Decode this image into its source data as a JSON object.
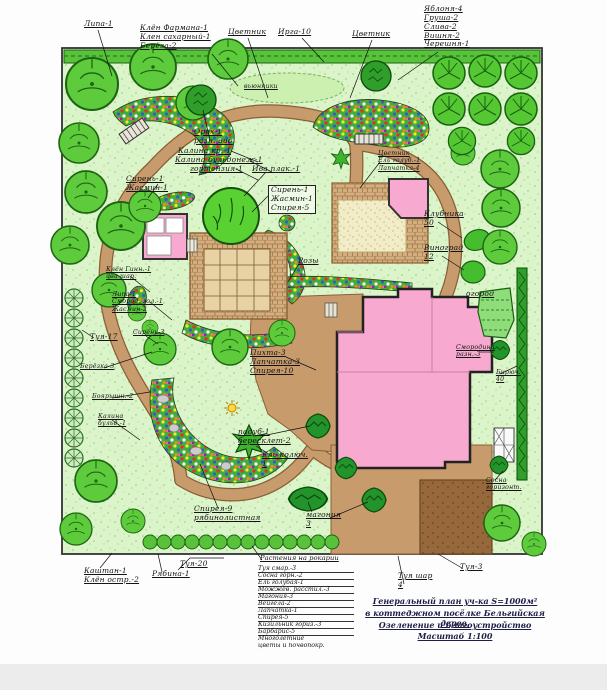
{
  "plan": {
    "callouts": {
      "lipa": "Липа-1",
      "maple_stack": "Клён Фармана-1\nКлен сахарный-1\nБерёза-2",
      "flowerbed_left": "Цветник",
      "irga": "Ирга-10",
      "flowerbed_right": "Цветник",
      "fruit_stack": "Яблоня-4\nГруша-2\nСлива-2\nВишня-2\nЧерешня-1",
      "lawn_oval": "вьюнники",
      "walnut": "Орех-1\nразн. вид",
      "kalina_kr": "Калина кр.-1",
      "kalina_buldonezh": "Калина бульдонеж-1",
      "gortenziya": "гортензия-1",
      "siren_zhasmin": "Сирень-1\nЖасмин-1",
      "iva_plak": "Ива плак.-1",
      "shrub_box": "Сирень-1\nЖасмин-1\nСпирея-5",
      "gazebo_stack": "Цветник\nЕль голуб.-1\nЛапчатка-4",
      "klubnika": "Клубника\n50",
      "vinograd": "Виноград\n12",
      "ogorod": "огород",
      "smorodina": "Смородина\nразн.-3",
      "biryuchina": "Бирюч.\n40",
      "rozy": "Розы",
      "pihta_box": "Пихта-3\nЛапчатка-3\nСпирея-10",
      "padub": "падуб-1\nбересклет-2",
      "el_kolyuchaya": "Ель колюч.\n1",
      "spireya_ryab": "Спирея-9\nрябинолистная",
      "magoniya": "магония\n3",
      "sosna_goriz": "Сосна\nгоризонт.",
      "tuya_17": "Туя-17",
      "beryozka": "Берёзка-3",
      "boyaryshnik": "Боярышн.-2",
      "kalina_buld_left": "Калина\nбульд.-1",
      "lipa_stack_left": "Липа-1\nСмород. зол.-1\nЖасмин-2",
      "siren_3": "Сирень-3",
      "klen_ginn": "Клён Гинн.-1\nива шар.",
      "kashtan": "Каштан-1\nКлён остр.-2",
      "ryabina": "Рябина-1",
      "tuya_20": "Туя-20",
      "tuya_shar": "Туя шар\n4",
      "tuya_3": "Туя-3"
    }
  },
  "legend": {
    "header": "Растения на рокарии",
    "items": [
      "Туя смар.-3",
      "Сосна горн.-2",
      "Ель голубая-1",
      "Можжев. расстил.-3",
      "Магония-3",
      "Вейгела-2",
      "Лапчатка-1",
      "Спирея-5",
      "Кизильник гориз.-3",
      "Барбарис-5",
      "Многолетние\nцветы и почвопокр."
    ]
  },
  "title_block": {
    "lines": [
      "Генеральный план уч-ка S=1000м²",
      "в коттеджном посёлке Бельгийская дерев.",
      "Озеленение и благоустройство",
      "Масштаб 1:100"
    ]
  },
  "colors": {
    "lawn": "#dcf4c9",
    "path_tan": "#c79b6c",
    "path_edge": "#8a5f36",
    "building_pink": "#f7a9cf",
    "flowerbed_green": "#3fae3c",
    "tree_green": "#4ec531",
    "dark_tree": "#2f9e2b",
    "drive_dark": "#96683c",
    "sand": "#f3ecc9",
    "border": "#333333"
  }
}
